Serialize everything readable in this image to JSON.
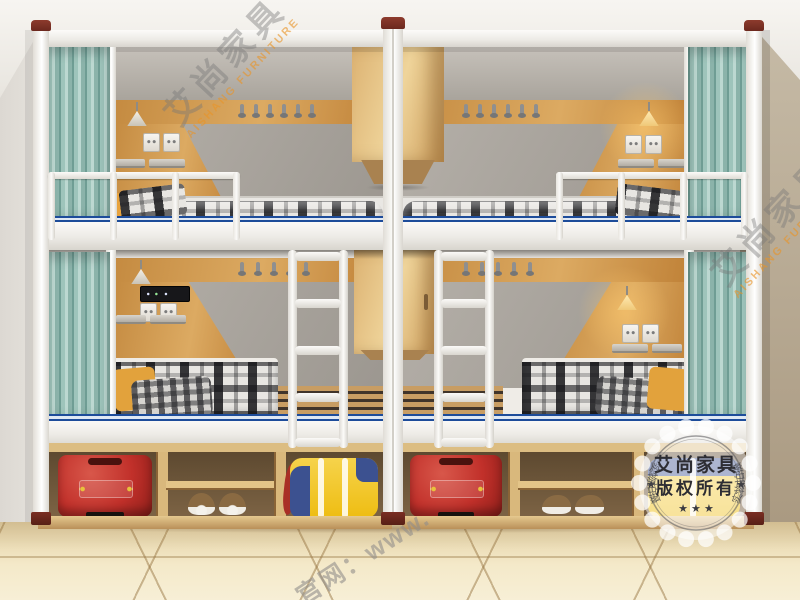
{
  "watermarks": {
    "brand_cn": "艾尚家具",
    "brand_en": "AISHANG FURNITURE",
    "website_cn": "官网：www.",
    "stamp": {
      "line1": "艾尚家具",
      "line2": "版权所有",
      "stars": "★ ★ ★",
      "star": "★",
      "ring_left": "实物拍摄",
      "ring_right": "实物拍摄"
    }
  },
  "colors": {
    "curtain_teal": "#9ec4bb",
    "wood_panel": "#cf9a50",
    "cabinet_wood": "#e3c280",
    "frame_white": "#f4f3f0",
    "blue_stripe": "#1d4c9a",
    "suitcase_red": "#c1302a",
    "bag_yellow": "#f2c41e",
    "bag_blue": "#3c5190",
    "pillow_orange": "#e8a33d",
    "floor_tile": "#eedfb8",
    "wall_right_tan": "#b4a48a",
    "post_cap_red": "#7a2e23"
  }
}
